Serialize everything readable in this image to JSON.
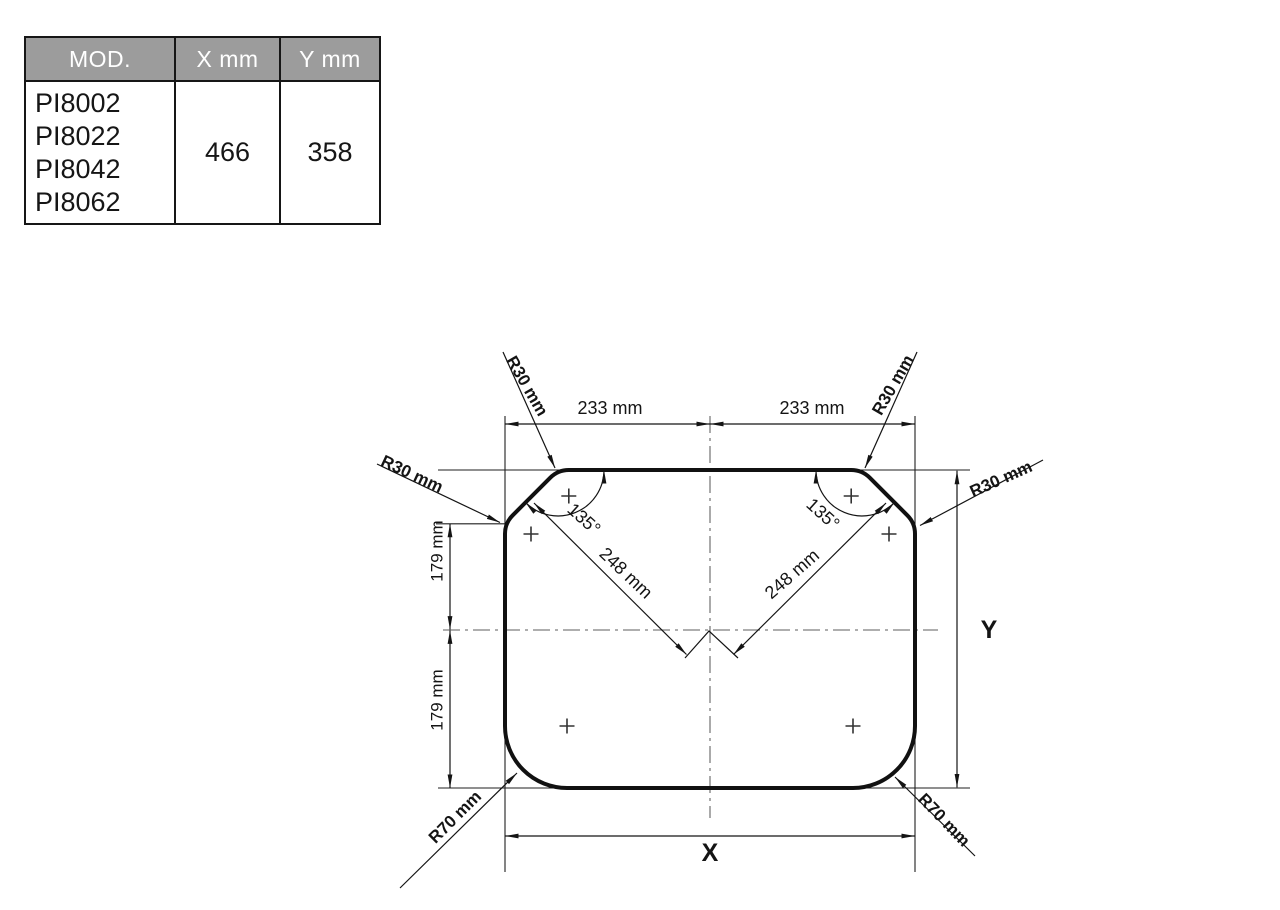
{
  "table": {
    "headers": [
      "MOD.",
      "X mm",
      "Y mm"
    ],
    "models": [
      "PI8002",
      "PI8022",
      "PI8042",
      "PI8062"
    ],
    "x_value": "466",
    "y_value": "358"
  },
  "diagram": {
    "labels": {
      "dim_233_left": "233 mm",
      "dim_233_right": "233 mm",
      "r30_top_left": "R30 mm",
      "r30_top_right": "R30 mm",
      "r30_left": "R30 mm",
      "r30_right": "R30 mm",
      "angle_left": "135°",
      "angle_right": "135°",
      "dim_248_left": "248 mm",
      "dim_248_right": "248 mm",
      "dim_179_upper": "179 mm",
      "dim_179_lower": "179 mm",
      "r70_left": "R70 mm",
      "r70_right": "R70 mm",
      "x_axis": "X",
      "y_axis": "Y"
    },
    "colors": {
      "drawing_line": "#141414",
      "centerline": "#7d7d7d",
      "table_header_bg": "#9c9c9c",
      "table_header_text": "#ffffff"
    }
  }
}
